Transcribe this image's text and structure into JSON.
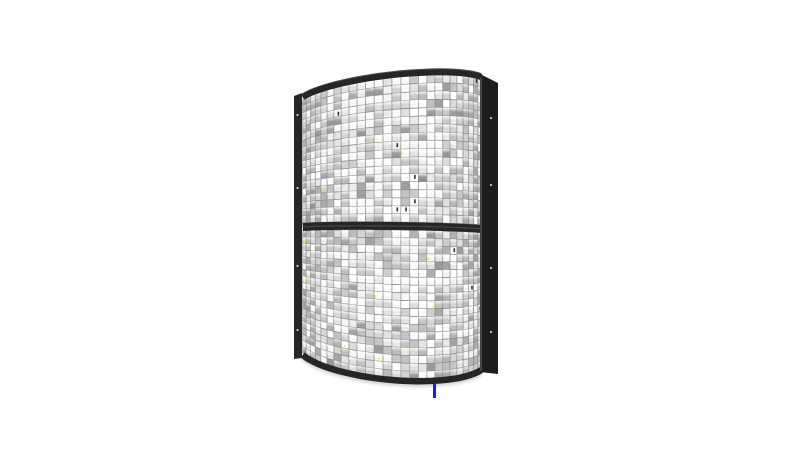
{
  "scene": {
    "description": "3D render of a curved two-section mirrored tile panel (cylindrical reflector array) on a white background",
    "background_color": "#ffffff",
    "canvas": {
      "width": 800,
      "height": 451
    },
    "panel": {
      "center_x": 392,
      "radius": 95,
      "max_angle_deg": 70,
      "columns": 26,
      "top_edge": {
        "left_y": 96,
        "center_y": 74,
        "right_y": 76
      },
      "mid_bar": {
        "left_y": 227,
        "center_y": 226,
        "right_y": 229,
        "thickness": 8
      },
      "bottom_edge": {
        "left_y": 356,
        "center_y": 381,
        "right_y": 371
      },
      "sections": [
        {
          "name": "upper",
          "rows": 18
        },
        {
          "name": "lower",
          "rows": 19
        }
      ],
      "frame": {
        "color": "#262626",
        "edge_highlight": "#4e4e4e",
        "right_post_color": "#1d1d1d",
        "right_post_inner_edge": "#5a5a5a",
        "left_post": {
          "x": 294,
          "width": 8,
          "top_y": 93,
          "bottom_y": 358
        },
        "right_post": {
          "x": 480,
          "width": 18,
          "top_y": 74,
          "bottom_y": 374
        },
        "rivet_color": "#c8c8c8",
        "left_rivets_y": [
          115,
          188,
          266,
          330
        ],
        "right_rivets_y": [
          118,
          185,
          268,
          332
        ]
      },
      "tiles": {
        "grid_line_color": "#8f8f8f",
        "base_color": "#d4d4d4",
        "bright_color": "#ffffff",
        "shade_color": "#9a9a9a",
        "dark_fleck_color": "#2f2f2f",
        "speck_color": "#f2f200",
        "speck_rate": 0.018,
        "dark_fleck_rate": 0.01,
        "bevel_skip_rate": 0.3,
        "seed": 1337
      }
    },
    "shadow": {
      "color": "#999999"
    },
    "marks": [
      {
        "name": "blue-tick",
        "color": "#0b24f5",
        "x": 433,
        "y": 384,
        "width": 3,
        "height": 14
      }
    ]
  }
}
